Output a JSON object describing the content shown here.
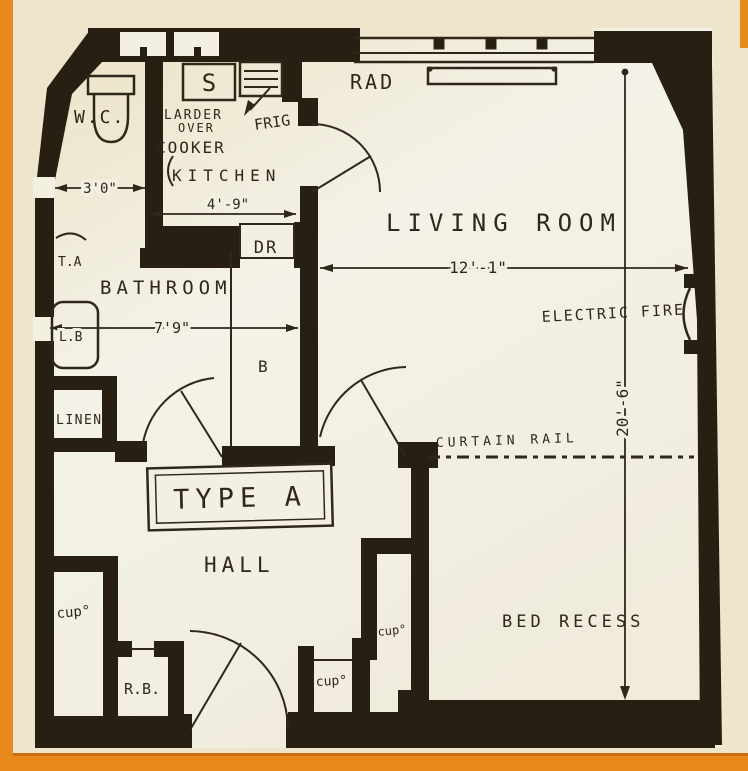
{
  "plan": {
    "type_label": "TYPE A",
    "rooms": {
      "wc": "W.C.",
      "kitchen": "KITCHEN",
      "bathroom": "BATHROOM",
      "living_room": "LIVING ROOM",
      "hall": "HALL",
      "bed_recess": "BED RECESS",
      "linen": "LINEN"
    },
    "fixtures": {
      "sink": "S",
      "fridge": "FRIG",
      "larder_line1": "LARDER",
      "larder_line2": "OVER",
      "cooker": "COOKER",
      "radiator": "RAD",
      "dresser": "DR",
      "bath": "B",
      "towel_airer": "T.A",
      "basin": "L.B",
      "electric_fire": "ELECTRIC FIRE",
      "curtain_rail": "CURTAIN RAIL"
    },
    "cupboards": {
      "left": "cup°",
      "lower": "cup°",
      "inner": "cup°",
      "refuse_bin": "R.B."
    },
    "dimensions": {
      "wc_width": "3'0\"",
      "kitchen_width": "4'-9\"",
      "bathroom_width": "7'9\"",
      "living_room_width": "12'-1\"",
      "living_room_length": "20'-6\""
    },
    "colors": {
      "wall": "#281f13",
      "paper": "#f3f0e2",
      "margin": "#efe5cc",
      "accent_orange": "#e8891b",
      "ink": "#30271b"
    }
  }
}
